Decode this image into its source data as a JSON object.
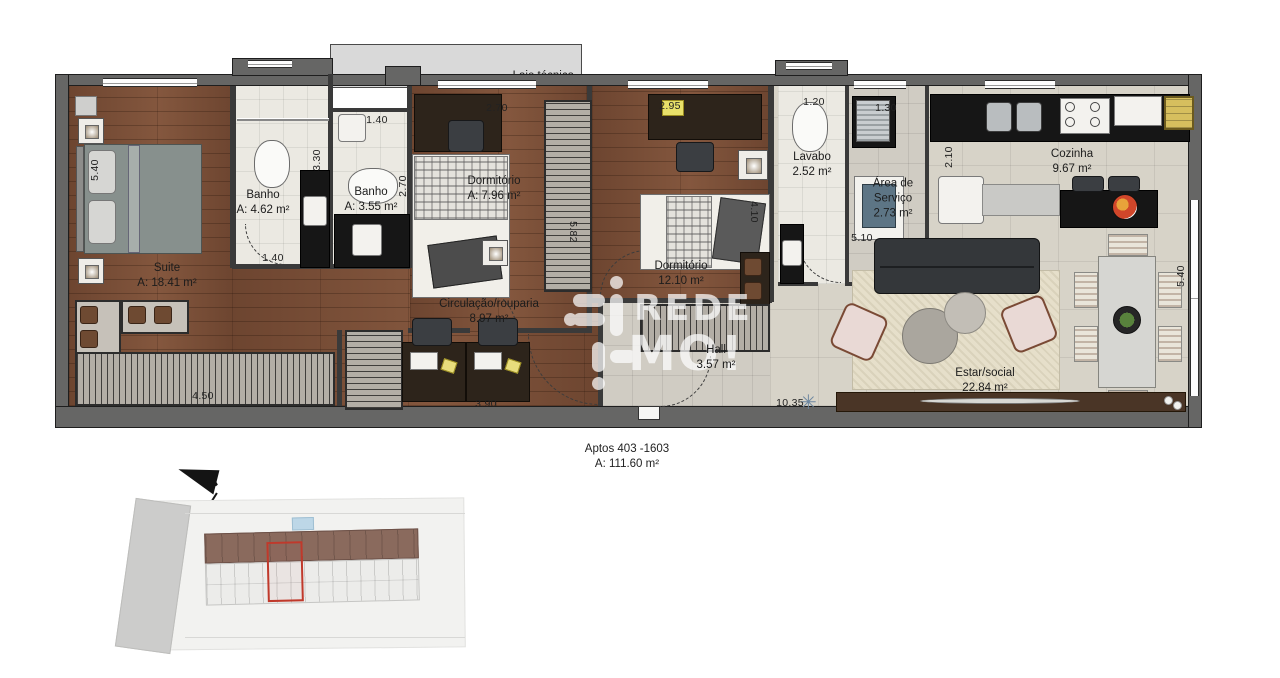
{
  "plan": {
    "laje": {
      "label": "Laje técnica"
    },
    "rooms": {
      "suite": {
        "name": "Suite",
        "area": "A: 18.41 m²"
      },
      "banho1": {
        "name": "Banho",
        "area": "A: 4.62 m²"
      },
      "banho2": {
        "name": "Banho",
        "area": "A: 3.55 m²"
      },
      "dormitorio1": {
        "name": "Dormitório",
        "area": "A: 7.96 m²"
      },
      "dormitorio2": {
        "name": "Dormitório",
        "area": "12.10 m²"
      },
      "lavabo": {
        "name": "Lavabo",
        "area": "2.52 m²"
      },
      "area_servico": {
        "name_line1": "Área de",
        "name_line2": "Serviço",
        "area": "2.73 m²"
      },
      "cozinha": {
        "name": "Cozinha",
        "area": "9.67 m²"
      },
      "circulacao": {
        "name": "Circulação/rouparia",
        "area": "8.97 m²"
      },
      "hall": {
        "name": "Hall",
        "area": "3.57 m²"
      },
      "estar": {
        "name": "Estar/social",
        "area": "22.84 m²"
      }
    },
    "dimensions": {
      "suite_depth": "5.40",
      "suite_closet_width": "4.50",
      "banho1_width": "1.40",
      "banho1_depth": "3.30",
      "banho2_width": "1.40",
      "banho2_depth": "2.70",
      "dorm1_width": "2.70",
      "corridor_depth": "5.82",
      "dorm2_width": "2.95",
      "dorm2_depth": "4.10",
      "lavabo_width": "1.20",
      "servico_width": "1.30",
      "cozinha_depth": "2.10",
      "estar_top_width": "5.10",
      "estar_bottom_width": "10.35",
      "estar_depth": "5.40",
      "circulacao_width": "3.90"
    }
  },
  "watermark": {
    "line1": "REDE",
    "line2": "MO!"
  },
  "footer": {
    "unit_range": "Aptos 403 -1603",
    "total_area": "A: 111.60 m²"
  },
  "site_plan": {
    "north_label": "N"
  },
  "colors": {
    "wood": "#7a5036",
    "walls": "#666665",
    "highlight_unit_outline": "#c0392b",
    "building_band": "#8a6a5d",
    "watermark": "#ffffff",
    "grill_yellow": "#d6bf5e"
  }
}
